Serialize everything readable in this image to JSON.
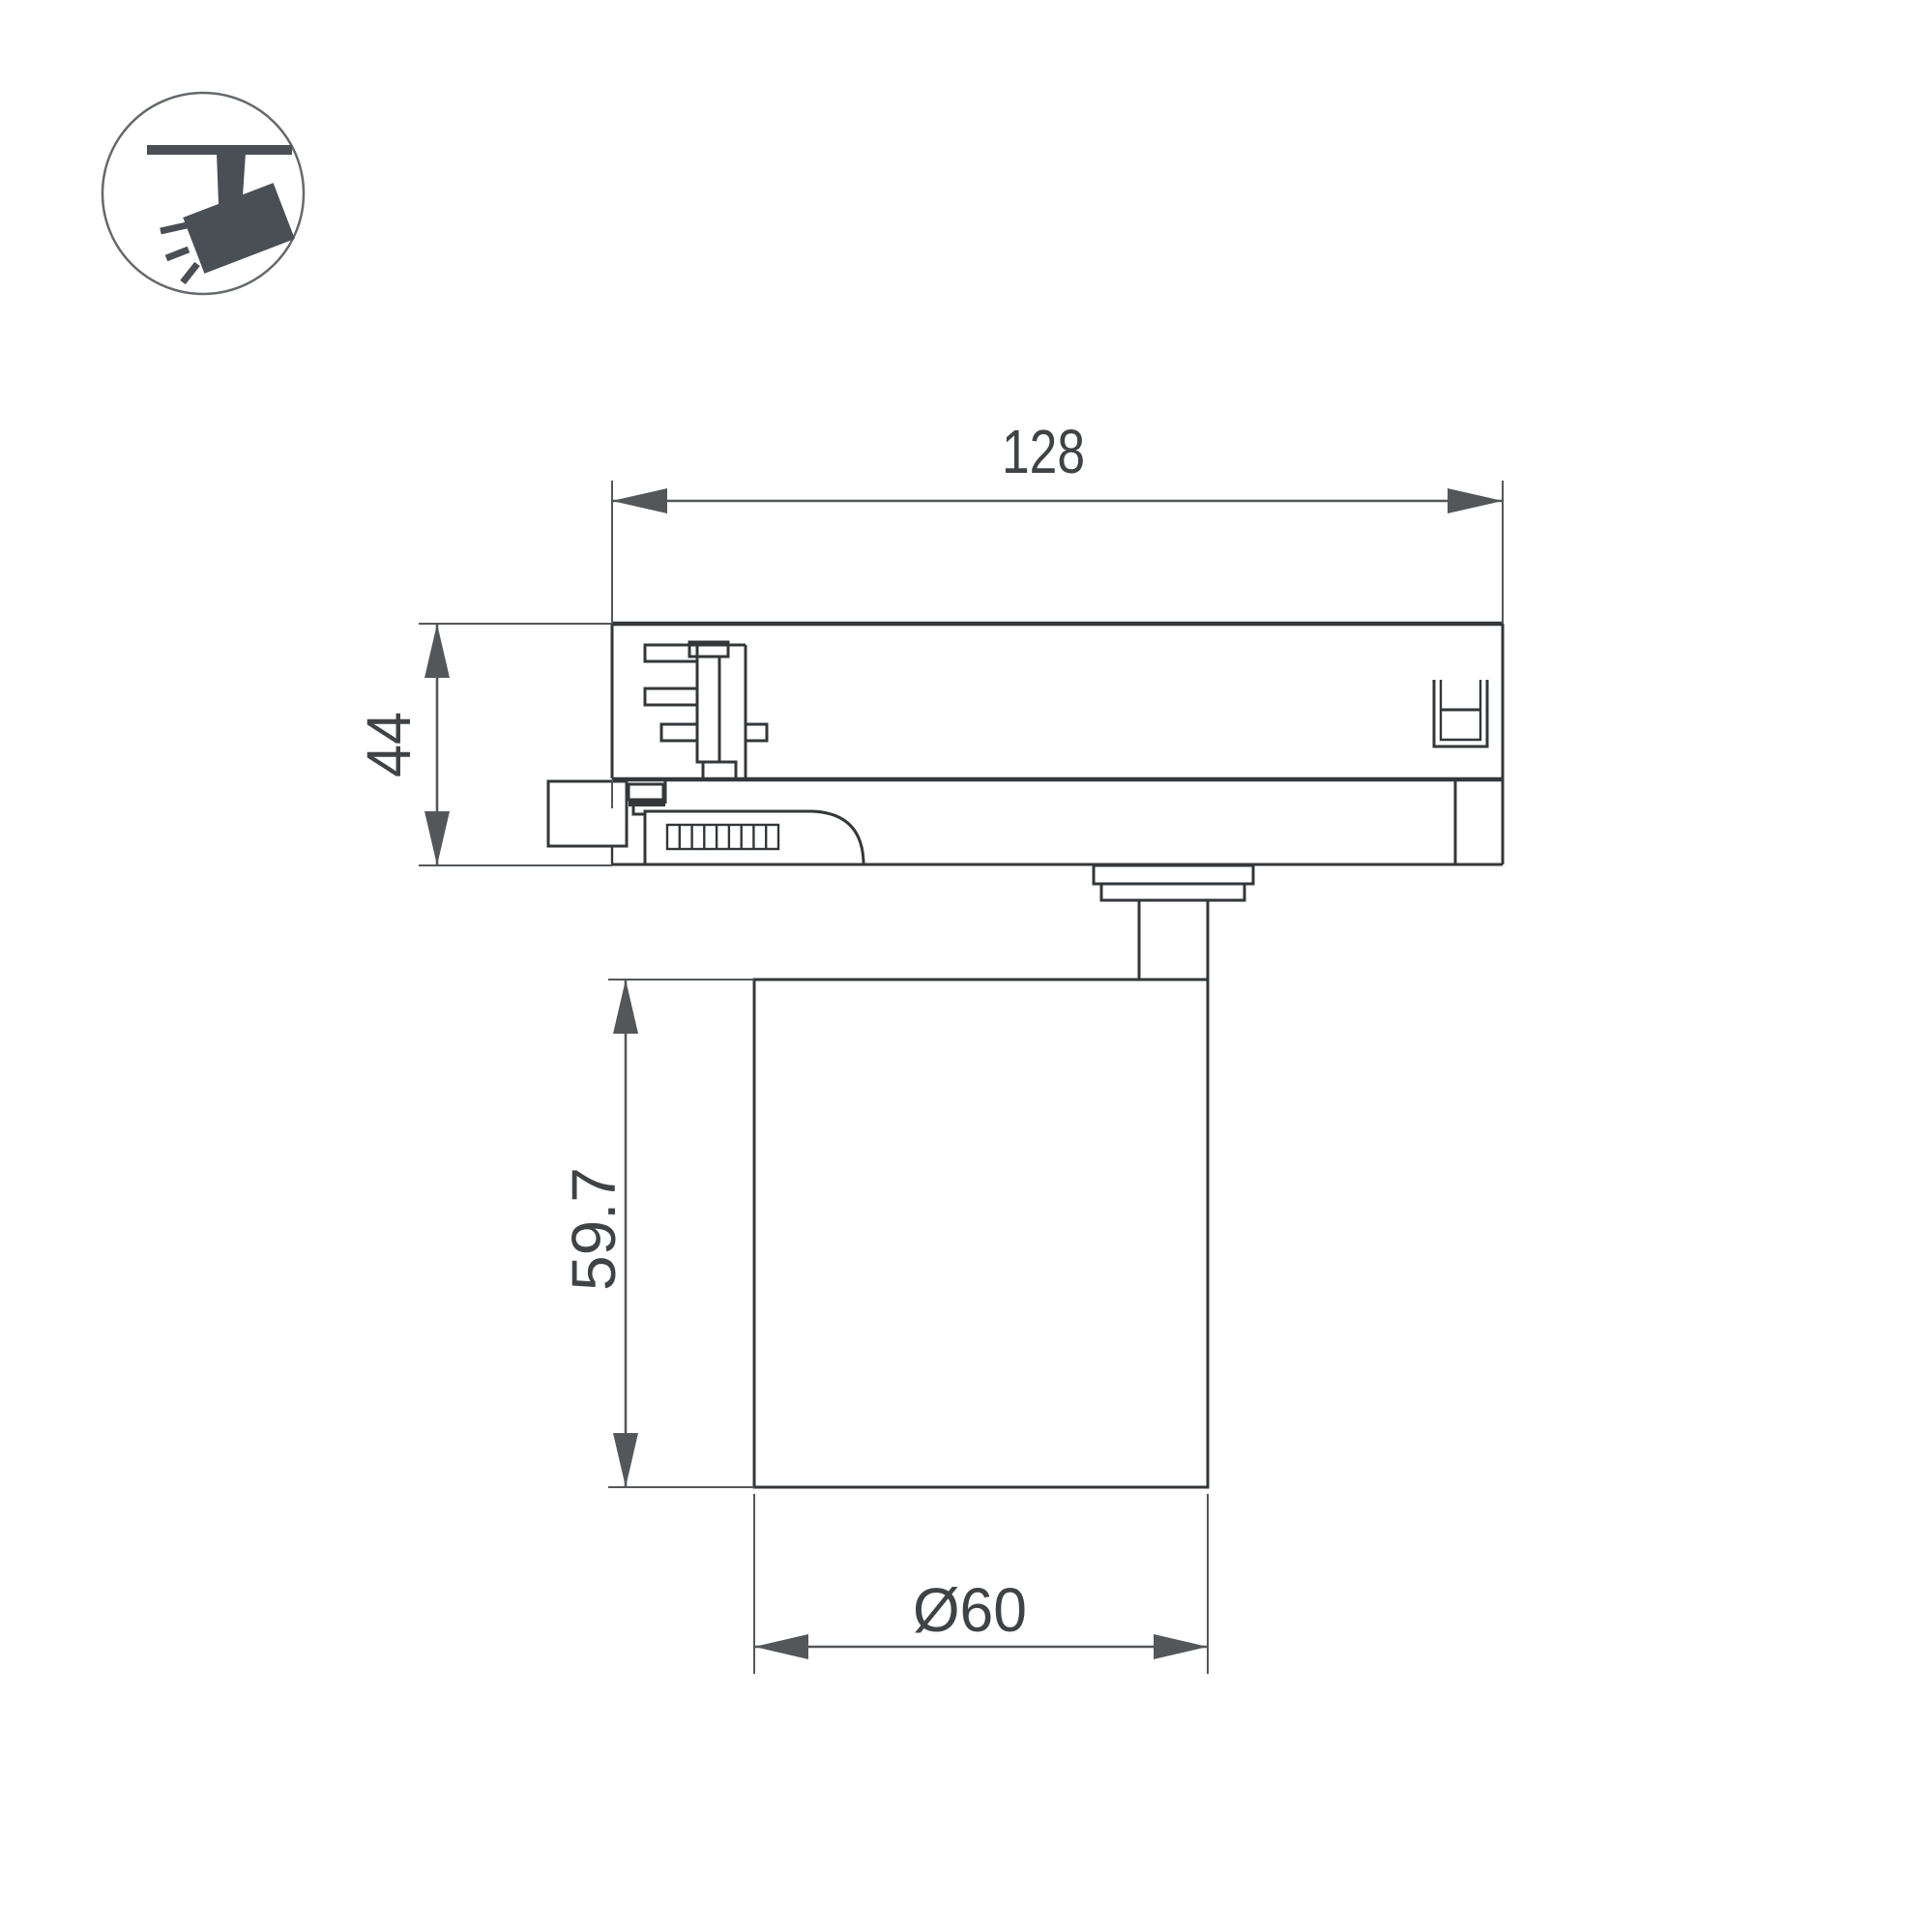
{
  "icon": {
    "name": "track-spotlight-icon"
  },
  "labels": {
    "track_width": "128",
    "track_height": "44",
    "body_height": "59.7",
    "body_diameter": "Ø60"
  },
  "colors": {
    "background": "#ffffff",
    "line": "#34373a",
    "dim": "#54575a",
    "text": "#404346",
    "icon": "#4a4f55",
    "icon_circle": "#65686c"
  }
}
